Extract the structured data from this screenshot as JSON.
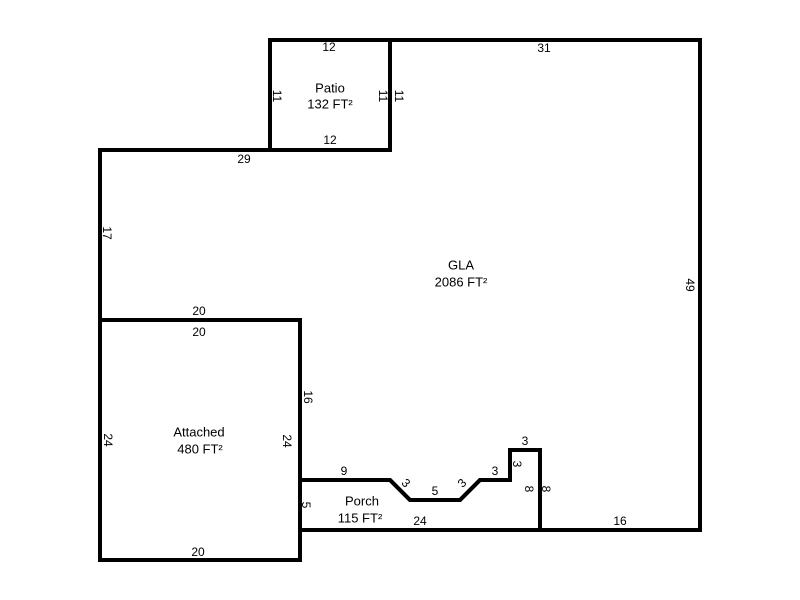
{
  "sketch": {
    "background_color": "#ffffff",
    "wall_color": "#000000",
    "label_color": "#000000",
    "rooms": {
      "patio": {
        "name": "Patio",
        "area": "132 FT²",
        "dims": {
          "top": "12",
          "left": "11",
          "right_inner": "11",
          "right_outer": "11",
          "bottom": "12"
        }
      },
      "gla": {
        "name": "GLA",
        "area": "2086 FT²",
        "dims": {
          "top": "31",
          "right": "49",
          "upper_left_top": "29",
          "left": "17",
          "above_garage": "20",
          "inner_left": "16",
          "bottom_right": "16",
          "porch_wall": "8"
        }
      },
      "attached": {
        "name": "Attached",
        "area": "480 FT²",
        "dims": {
          "top": "20",
          "left": "24",
          "right": "24",
          "bottom": "20"
        }
      },
      "porch": {
        "name": "Porch",
        "area": "115 FT²",
        "dims": {
          "left": "5",
          "top": "9",
          "diag_left": "3",
          "middle": "5",
          "diag_right": "3",
          "step": "3",
          "notch_side": "3",
          "notch_top": "3",
          "right": "8",
          "bottom": "24"
        }
      }
    }
  }
}
